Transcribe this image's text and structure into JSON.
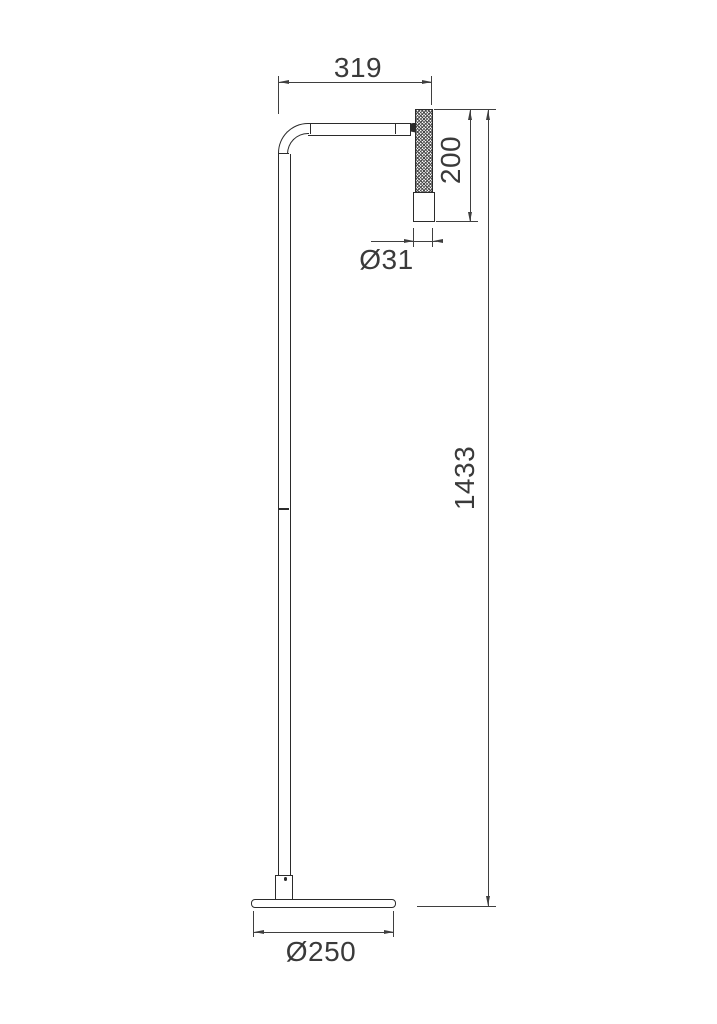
{
  "drawing": {
    "kind": "dimensioned line drawing",
    "dimensions": {
      "arm_projection": {
        "label": "319"
      },
      "head_length": {
        "label": "200"
      },
      "head_diameter": {
        "label": "Ø31"
      },
      "total_height": {
        "label": "1433"
      },
      "base_diameter": {
        "label": "Ø250"
      }
    }
  },
  "colors": {
    "line": "#2b2b2b",
    "dim": "#3f3f3f",
    "text": "#3a3a3a",
    "bg": "#ffffff",
    "knurl": "#474747"
  }
}
